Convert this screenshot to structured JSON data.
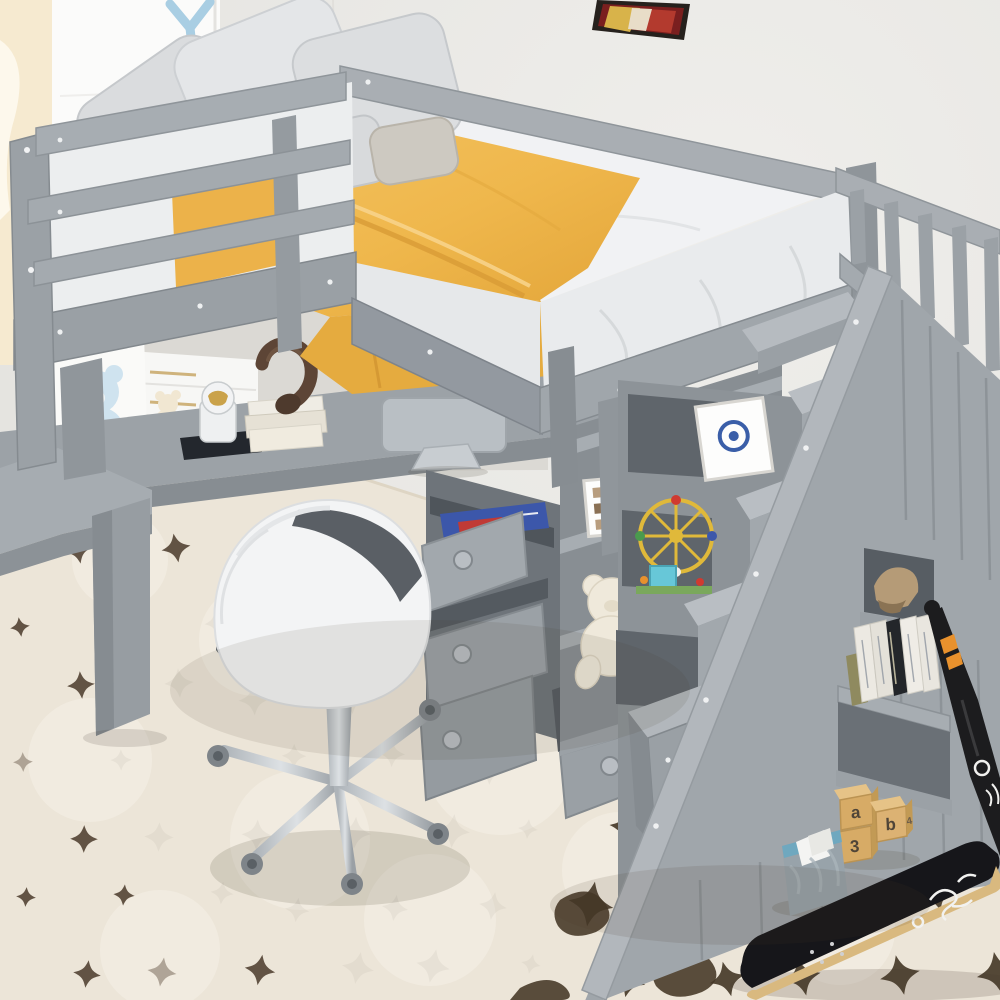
{
  "meta": {
    "type": "product-photo",
    "subject": "Gray twin loft bed with L-shaped desk, chest of drawers, open shelving, storage staircase and rolling desk chair in a kids room"
  },
  "palette": {
    "wall": "#e9e8e5",
    "bed_gray": "#a4aaaf",
    "bed_gray_light": "#b9bec3",
    "bed_gray_dark": "#8a9095",
    "mattress_white": "#f1f2f4",
    "blanket_yellow": "#f0b950",
    "pillow_gray": "#d7d9db",
    "rug_cream": "#ece5d8",
    "rug_star_brown": "#4a392a",
    "wood_floor": "#d6c3a2",
    "chair_white": "#f3f4f5",
    "chair_cushion": "#565b61",
    "chrome": "#c3c9ce",
    "skateboard_black": "#16161a",
    "bat_black": "#1c1c1e",
    "bat_orange": "#e8912d",
    "bin_gray": "#98a3aa",
    "bin_teal": "#6fa8bf",
    "block_wood": "#d9b478",
    "headphones_brown": "#5d4536",
    "blue_book": "#3c57aa",
    "bear_cutout_blue": "#cfe3ef"
  },
  "bed": {
    "pillow_count": 7,
    "rails": "double guard rail",
    "screws_visible": true
  },
  "objects": {
    "blocks": {
      "letters": [
        "a",
        "b",
        "3",
        "4"
      ]
    },
    "charcoal_book": {
      "line1": "NATIVE",
      "line2": "CHARCOAL"
    },
    "frames": {
      "count": 3
    },
    "teddy_bears": {
      "count": 2
    },
    "books_on_desk": {
      "count": 3
    },
    "stair_books": {
      "count": 5
    }
  }
}
